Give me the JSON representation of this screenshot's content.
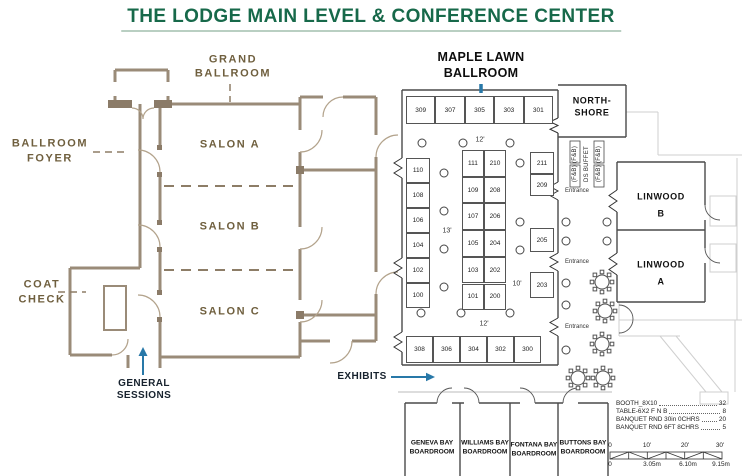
{
  "title": "THE LODGE MAIN LEVEL & CONFERENCE CENTER",
  "colors": {
    "title_green": "#17694a",
    "wall_tan": "#9a8b78",
    "label_brown": "#6f5f3e",
    "plan_black": "#4a4a4a",
    "arrow_blue": "#2878a8",
    "faint_gray": "#cfcfcf"
  },
  "lodge": {
    "grand_ballroom_line1": "GRAND",
    "grand_ballroom_line2": "BALLROOM",
    "salon_a": "SALON A",
    "salon_b": "SALON B",
    "salon_c": "SALON C",
    "ballroom_foyer_line1": "BALLROOM",
    "ballroom_foyer_line2": "FOYER",
    "coat_check_line1": "COAT",
    "coat_check_line2": "CHECK",
    "general_sessions_line1": "GENERAL",
    "general_sessions_line2": "SESSIONS"
  },
  "exhibit_hall": {
    "name_line1": "MAPLE LAWN",
    "name_line2": "BALLROOM",
    "exhibits_label": "EXHIBITS",
    "entrance_label": "Entrance",
    "aisle_top": "12'",
    "aisle_left": "13'",
    "aisle_right": "10'",
    "aisle_bottom": "12'",
    "top_row": [
      "309",
      "307",
      "305",
      "303",
      "301"
    ],
    "left_column": [
      "110",
      "108",
      "106",
      "104",
      "102",
      "100"
    ],
    "center_left_column": [
      "111",
      "109",
      "107",
      "105",
      "103",
      "101"
    ],
    "center_right_column": [
      "210",
      "208",
      "206",
      "204",
      "202",
      "200"
    ],
    "right_column": [
      "211",
      "209",
      "205",
      "203"
    ],
    "bottom_row": [
      "308",
      "306",
      "304",
      "302",
      "300"
    ]
  },
  "rooms": {
    "north_shore_line1": "NORTH-",
    "north_shore_line2": "SHORE",
    "linwood_b_line1": "LINWOOD",
    "linwood_b_line2": "B",
    "linwood_a_line1": "LINWOOD",
    "linwood_a_line2": "A"
  },
  "buffet": {
    "side_label": "(F&B) (F&B)",
    "center_label": "DS BUFFET"
  },
  "boardrooms": [
    {
      "line1": "GENEVA BAY",
      "line2": "BOARDROOM"
    },
    {
      "line1": "WILLIAMS BAY",
      "line2": "BOARDROOM"
    },
    {
      "line1": "FONTANA BAY",
      "line2": "BOARDROOM"
    },
    {
      "line1": "BUTTONS BAY",
      "line2": "BOARDROOM"
    }
  ],
  "legend": {
    "items": [
      {
        "label": "BOOTH_8X10",
        "value": "32"
      },
      {
        "label": "TABLE-6X2 F N B",
        "value": "8"
      },
      {
        "label": "BANQUET RND 30in 0CHRS",
        "value": "20"
      },
      {
        "label": "BANQUET RND 6FT 8CHRS",
        "value": "5"
      }
    ]
  },
  "scale_bar": {
    "feet": [
      "0",
      "10'",
      "20'",
      "30'"
    ],
    "meters": [
      "0",
      "3.05m",
      "6.10m",
      "9.15m"
    ]
  }
}
